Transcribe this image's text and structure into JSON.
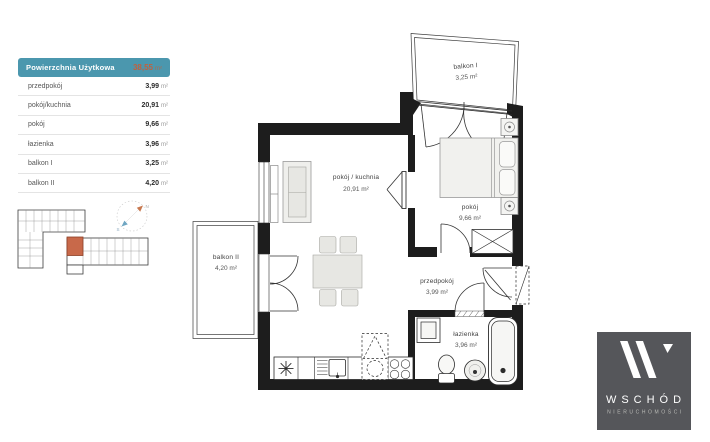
{
  "table": {
    "header": {
      "label": "Powierzchnia Użytkowa",
      "value": "38,55",
      "unit": "m²"
    },
    "rows": [
      {
        "label": "przedpokój",
        "value": "3,99",
        "unit": "m²"
      },
      {
        "label": "pokój/kuchnia",
        "value": "20,91",
        "unit": "m²"
      },
      {
        "label": "pokój",
        "value": "9,66",
        "unit": "m²"
      },
      {
        "label": "łazienka",
        "value": "3,96",
        "unit": "m²"
      },
      {
        "label": "balkon I",
        "value": "3,25",
        "unit": "m²"
      },
      {
        "label": "balkon II",
        "value": "4,20",
        "unit": "m²"
      }
    ]
  },
  "plan": {
    "rooms": [
      {
        "name": "balkon I",
        "area": "3,25 m²"
      },
      {
        "name": "pokój / kuchnia",
        "area": "20,91 m²"
      },
      {
        "name": "pokój",
        "area": "9,66 m²"
      },
      {
        "name": "balkon II",
        "area": "4,20 m²"
      },
      {
        "name": "przedpokój",
        "area": "3,99 m²"
      },
      {
        "name": "łazienka",
        "area": "3,96 m²"
      }
    ]
  },
  "compass": {
    "north": "N",
    "south": "S"
  },
  "logo": {
    "name": "WSCHÓD",
    "subtitle": "NIERUCHOMOŚCI"
  },
  "colors": {
    "teal": "#4B97AE",
    "orange": "#C0613F",
    "wall": "#1D1D1D",
    "logo_bg": "#55565A",
    "unit_highlight": "#C8694A"
  }
}
